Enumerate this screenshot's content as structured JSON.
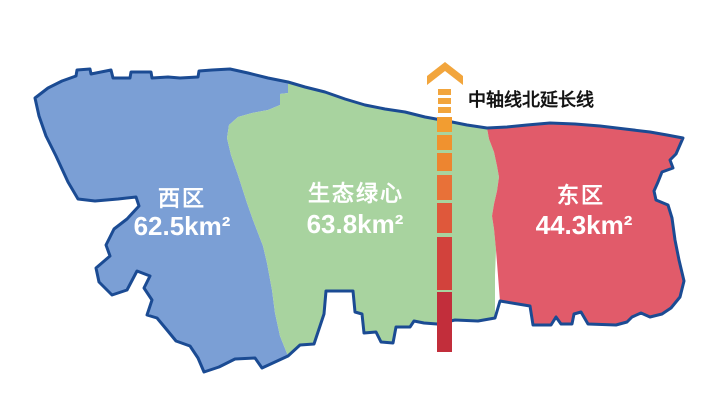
{
  "regions": {
    "west": {
      "name": "西区",
      "area": "62.5km²"
    },
    "green": {
      "name": "生态绿心",
      "area": "63.8km²"
    },
    "east": {
      "name": "东区",
      "area": "44.3km²"
    }
  },
  "axis": {
    "label": "中轴线北延长线",
    "arrow_color": "#f2a53c",
    "segment_colors": [
      "#f2a53c",
      "#f2a53c",
      "#f2a53c",
      "#f29d31",
      "#f0922f",
      "#ed8530",
      "#e87138",
      "#df583b",
      "#d2423c",
      "#c22e3b"
    ]
  },
  "colors": {
    "west_fill": "#7b9fd5",
    "green_fill": "#a8d39f",
    "east_fill": "#e15b6a",
    "outline": "#1b4b93",
    "region_text": "#ffffff",
    "axis_label_text": "#141414"
  }
}
